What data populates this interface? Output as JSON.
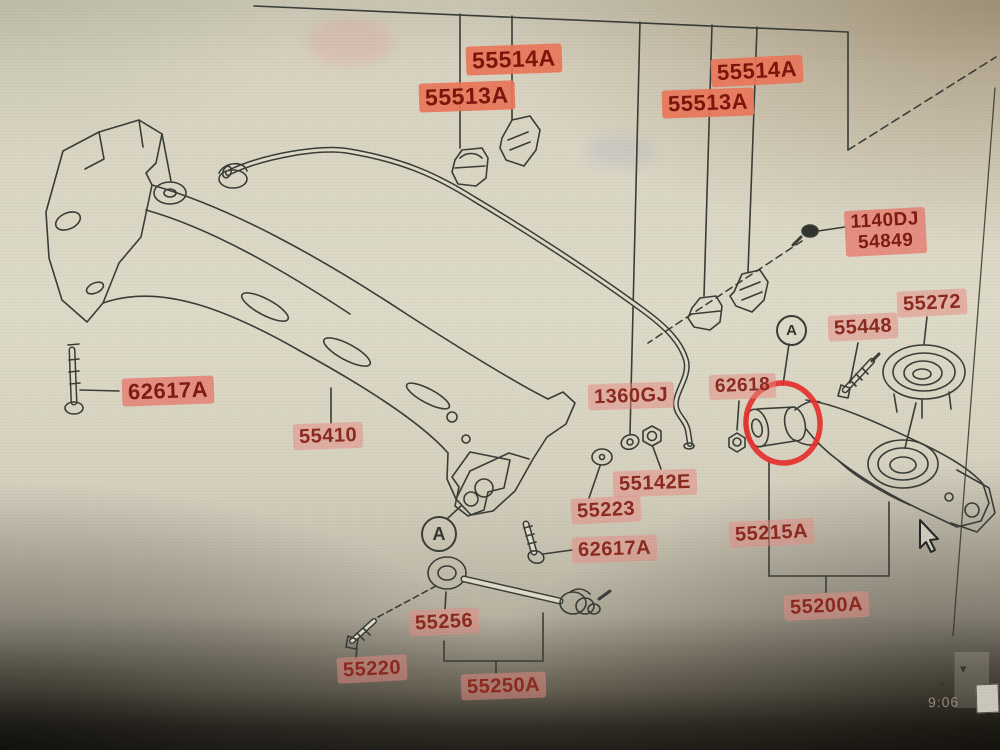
{
  "window": {
    "time": "9:06",
    "icons": {
      "scroll_down": "▾",
      "scroll_right": "▸"
    }
  },
  "colors": {
    "highlight_strong": "#ec765a",
    "highlight_light": "#e78c85",
    "label_text": "#8c2a20",
    "line": "#3a3d38",
    "annotation_red": "#e8302e",
    "paper": "#dfdbc9"
  },
  "diagram": {
    "marker_a": "A",
    "labels": {
      "stab_bracket_left": "55514A",
      "stab_bushing_left": "55513A",
      "stab_bracket_right": "55514A",
      "stab_bushing_right": "55513A",
      "bolt_top_right_line1": "1140DJ",
      "bolt_top_right_line2": "54849",
      "spring_seat": "55272",
      "arm_bolt": "55448",
      "arm_nut": "62618",
      "stab_washer": "1360GJ",
      "bolt_left": "62617A",
      "crossmember": "55410",
      "stab_nut": "55142E",
      "washer_center": "55223",
      "bolt_center": "62617A",
      "arm_bushing": "55215A",
      "rod_bushing": "55256",
      "rod_bolt": "55220",
      "rod_assembly": "55250A",
      "arm_assembly": "55200A"
    }
  }
}
